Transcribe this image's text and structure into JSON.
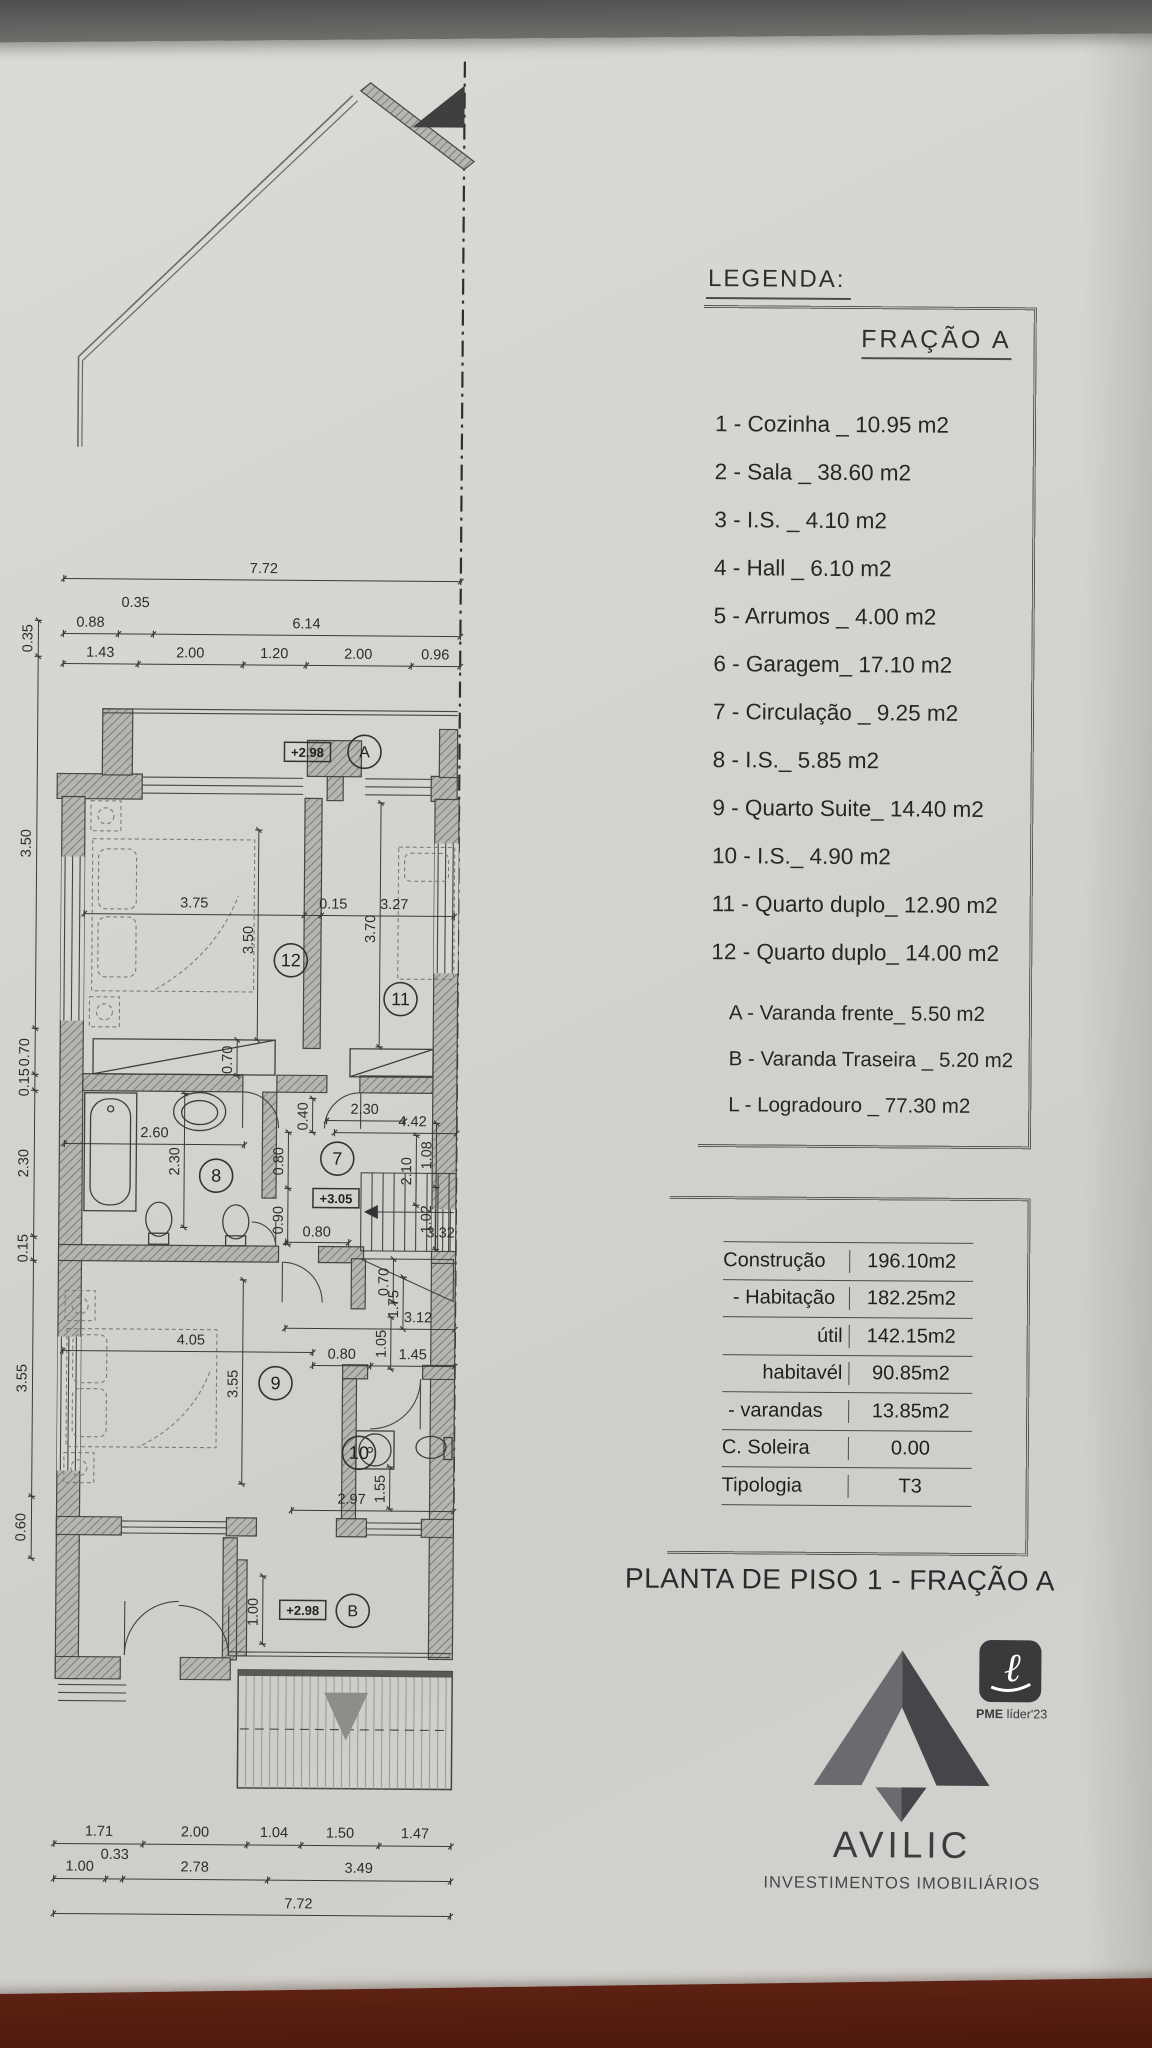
{
  "photo": {
    "paper_color": "#d4d3cf",
    "table_color": "#4f1a0e",
    "top_band_color": "#55555a",
    "ink_color": "#3a3a3a"
  },
  "legend": {
    "title": "LEGENDA:",
    "fraction": "FRAÇÃO A",
    "items": [
      "1 - Cozinha _ 10.95 m2",
      "2 - Sala _ 38.60 m2",
      "3 - I.S. _ 4.10 m2",
      "4 - Hall _ 6.10 m2",
      "5 - Arrumos _ 4.00 m2",
      "6 - Garagem_ 17.10 m2",
      "7 - Circulação _ 9.25 m2",
      "8 - I.S._ 5.85 m2",
      "9 - Quarto Suite_ 14.40 m2",
      "10 - I.S._ 4.90 m2",
      "11 - Quarto duplo_ 12.90 m2",
      "12 - Quarto duplo_ 14.00 m2"
    ],
    "annex_items": [
      "A - Varanda frente_ 5.50 m2",
      "B - Varanda Traseira _ 5.20 m2",
      "L - Logradouro _ 77.30 m2"
    ]
  },
  "areas_table": {
    "rows": [
      {
        "label": "Construção",
        "value": "196.10m2"
      },
      {
        "label": "- Habitação",
        "value": "182.25m2"
      },
      {
        "label": "útil",
        "value": "142.15m2"
      },
      {
        "label": "habitavél",
        "value": "90.85m2"
      },
      {
        "label": "- varandas",
        "value": "13.85m2"
      },
      {
        "label": "C. Soleira",
        "value": "0.00"
      },
      {
        "label": "Tipologia",
        "value": "T3"
      }
    ]
  },
  "plan_title": "PLANTA DE PISO 1 - FRAÇÃO A",
  "logo": {
    "name": "AVILIC",
    "subtitle": "INVESTIMENTOS IMOBILIÁRIOS",
    "badge_pme": "PME",
    "badge_rest": "líder'23"
  },
  "floor_plan": {
    "room_labels": [
      {
        "n": "7",
        "x": 333,
        "y": 1118
      },
      {
        "n": "8",
        "x": 212,
        "y": 1136
      },
      {
        "n": "9",
        "x": 273,
        "y": 1343
      },
      {
        "n": "10",
        "x": 357,
        "y": 1412
      },
      {
        "n": "11",
        "x": 395,
        "y": 958
      },
      {
        "n": "12",
        "x": 285,
        "y": 920
      }
    ],
    "level_markers": [
      {
        "t": "+2.98",
        "x": 300,
        "y": 712
      },
      {
        "t": "+3.05",
        "x": 332,
        "y": 1158
      },
      {
        "t": "+2.98",
        "x": 302,
        "y": 1570
      }
    ],
    "balcony_labels": [
      {
        "t": "A",
        "x": 357,
        "y": 711
      },
      {
        "t": "B",
        "x": 352,
        "y": 1570
      }
    ],
    "dim_chains": [
      "55,540 452,540",
      "55,595 110,595 145,595 452,595",
      "55,625 130,625 235,625 298,625 403,625 452,625",
      "78,875 298,875 315,875 448,875",
      "60,1105 240,1105",
      "322,1080 400,1080",
      "330,1092 452,1092",
      "282,1202 345,1202",
      "282,1288 452,1288",
      "310,1325 368,1325 452,1325",
      "60,1312 310,1312",
      "290,1470 452,1470",
      "55,1805 144,1805 248,1805 302,1805 380,1805 452,1805",
      "55,1840 107,1840 124,1840 269,1840 452,1840",
      "55,1875 452,1875",
      "30,582 30,618 30,990 30,1036 30,1052 30,1198 30,1222 30,1458 30,1520",
      "252,790 252,1000",
      "374,762 374,1006",
      "232,1000 232,1036",
      "180,1054 180,1188",
      "284,1092 284,1148 284,1204",
      "308,1058 308,1092",
      "412,1094 412,1164",
      "432,1082 432,1146 432,1208",
      "390,1218 390,1262",
      "400,1236 400,1288",
      "388,1276 388,1328",
      "240,1240 240,1444",
      "388,1426 388,1468",
      "262,1536 262,1604"
    ],
    "dim_labels": [
      {
        "t": "7.72",
        "x": 255,
        "y": 533
      },
      {
        "t": "0.88",
        "x": 82,
        "y": 588
      },
      {
        "t": "0.35",
        "x": 127,
        "y": 568
      },
      {
        "t": "6.14",
        "x": 298,
        "y": 588
      },
      {
        "t": "1.43",
        "x": 92,
        "y": 618
      },
      {
        "t": "2.00",
        "x": 182,
        "y": 618
      },
      {
        "t": "1.20",
        "x": 266,
        "y": 618
      },
      {
        "t": "2.00",
        "x": 350,
        "y": 618
      },
      {
        "t": "0.96",
        "x": 427,
        "y": 618
      },
      {
        "t": "3.75",
        "x": 188,
        "y": 868
      },
      {
        "t": "0.15",
        "x": 327,
        "y": 868
      },
      {
        "t": "3.27",
        "x": 388,
        "y": 868
      },
      {
        "t": "3.50",
        "x": 247,
        "y": 900,
        "r": 1
      },
      {
        "t": "3.70",
        "x": 369,
        "y": 888,
        "r": 1
      },
      {
        "t": "0.70",
        "x": 227,
        "y": 1020,
        "r": 1
      },
      {
        "t": "2.60",
        "x": 150,
        "y": 1098
      },
      {
        "t": "2.30",
        "x": 175,
        "y": 1122,
        "r": 1
      },
      {
        "t": "0.40",
        "x": 303,
        "y": 1076,
        "r": 1
      },
      {
        "t": "2.30",
        "x": 360,
        "y": 1073
      },
      {
        "t": "4.42",
        "x": 408,
        "y": 1085
      },
      {
        "t": "0.80",
        "x": 279,
        "y": 1121,
        "r": 1
      },
      {
        "t": "0.90",
        "x": 279,
        "y": 1180,
        "r": 1
      },
      {
        "t": "0.80",
        "x": 313,
        "y": 1196
      },
      {
        "t": "3.32",
        "x": 437,
        "y": 1196
      },
      {
        "t": "2.10",
        "x": 407,
        "y": 1130,
        "r": 1
      },
      {
        "t": "1.08",
        "x": 427,
        "y": 1114,
        "r": 1
      },
      {
        "t": "1.02",
        "x": 427,
        "y": 1178,
        "r": 1
      },
      {
        "t": "0.70",
        "x": 385,
        "y": 1241,
        "r": 1
      },
      {
        "t": "1.75",
        "x": 395,
        "y": 1263,
        "r": 1
      },
      {
        "t": "3.12",
        "x": 415,
        "y": 1281
      },
      {
        "t": "1.05",
        "x": 383,
        "y": 1303,
        "r": 1
      },
      {
        "t": "0.80",
        "x": 339,
        "y": 1318
      },
      {
        "t": "1.45",
        "x": 410,
        "y": 1318
      },
      {
        "t": "4.05",
        "x": 188,
        "y": 1305
      },
      {
        "t": "3.55",
        "x": 235,
        "y": 1344,
        "r": 1
      },
      {
        "t": "2.97",
        "x": 350,
        "y": 1463
      },
      {
        "t": "1.55",
        "x": 383,
        "y": 1448,
        "r": 1
      },
      {
        "t": "1.00",
        "x": 257,
        "y": 1572,
        "r": 1
      },
      {
        "t": "1.71",
        "x": 100,
        "y": 1797
      },
      {
        "t": "2.00",
        "x": 196,
        "y": 1797
      },
      {
        "t": "1.04",
        "x": 275,
        "y": 1797
      },
      {
        "t": "1.50",
        "x": 341,
        "y": 1797
      },
      {
        "t": "1.47",
        "x": 416,
        "y": 1797
      },
      {
        "t": "1.00",
        "x": 81,
        "y": 1832
      },
      {
        "t": "0.33",
        "x": 116,
        "y": 1820
      },
      {
        "t": "2.78",
        "x": 196,
        "y": 1832
      },
      {
        "t": "3.49",
        "x": 360,
        "y": 1832
      },
      {
        "t": "7.72",
        "x": 300,
        "y": 1868
      },
      {
        "t": "0.35",
        "x": 24,
        "y": 600,
        "r": 1
      },
      {
        "t": "3.50",
        "x": 24,
        "y": 805,
        "r": 1
      },
      {
        "t": "0.70",
        "x": 24,
        "y": 1014,
        "r": 1
      },
      {
        "t": "0.15",
        "x": 24,
        "y": 1044,
        "r": 1
      },
      {
        "t": "2.30",
        "x": 24,
        "y": 1125,
        "r": 1
      },
      {
        "t": "0.15",
        "x": 24,
        "y": 1210,
        "r": 1
      },
      {
        "t": "3.55",
        "x": 24,
        "y": 1340,
        "r": 1
      },
      {
        "t": "0.60",
        "x": 24,
        "y": 1489,
        "r": 1
      }
    ]
  }
}
